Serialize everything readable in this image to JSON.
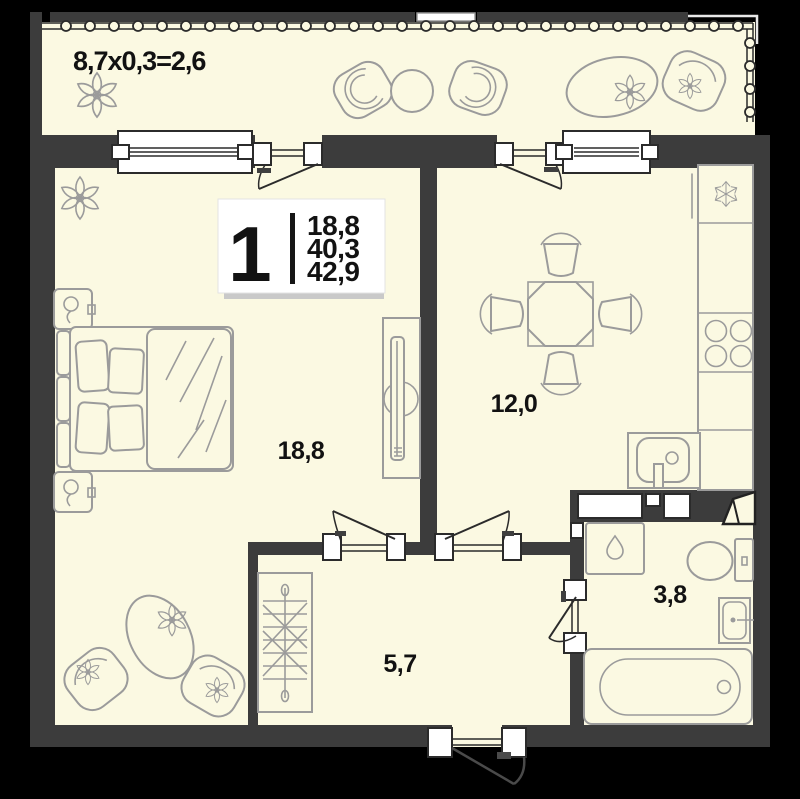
{
  "plan": {
    "balcony_label": "8,7x0,3=2,6",
    "rooms": [
      {
        "name": "living-bedroom",
        "area_label": "18,8"
      },
      {
        "name": "kitchen-dining",
        "area_label": "12,0"
      },
      {
        "name": "hallway",
        "area_label": "5,7"
      },
      {
        "name": "bathroom",
        "area_label": "3,8"
      }
    ],
    "info_plate": {
      "rooms_count": "1",
      "living_area": "18,8",
      "area": "40,3",
      "total_area": "42,9"
    },
    "icons": {
      "fridge": "snowflake",
      "washing_machine": "droplet",
      "wardrobe": "hanger-rail",
      "plants": "flower"
    },
    "colors": {
      "bg": "#000000",
      "wall": "#3c3c3c",
      "floor": "#fbf9e2",
      "furn": "#9b9b9b",
      "frame": "#2b2b2b",
      "ink": "#121212",
      "plate_shadow": "#c9c9c9"
    }
  }
}
